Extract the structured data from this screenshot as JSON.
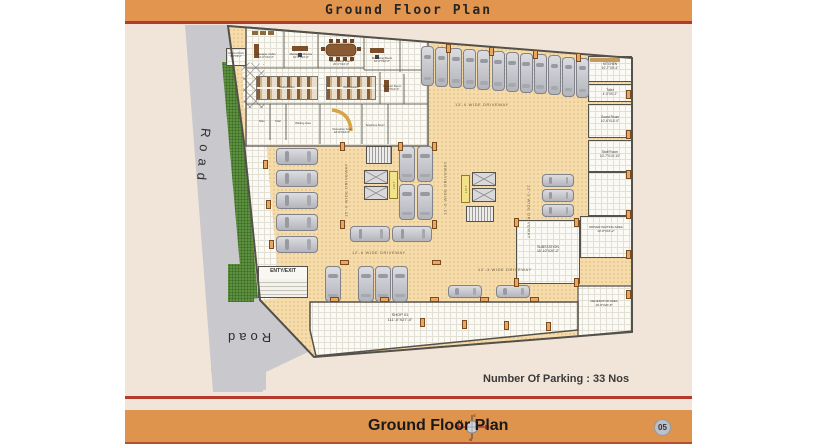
{
  "header": {
    "title": "Ground Floor Plan"
  },
  "footer": {
    "title": "Ground Floor Plan",
    "page": "05",
    "compass": {
      "n": "N",
      "e": "E",
      "s": "S",
      "w": "W"
    }
  },
  "notes": {
    "parking": "Number Of Parking : 33 Nos"
  },
  "roads": {
    "left": "Road",
    "bottom": "Road"
  },
  "driveways": {
    "top": "13'-0 WIDE DRIVEWAY",
    "left": "15'-0 WIDE DRIVEWAY",
    "mid": "12'-0 WIDE DRIVEWAY",
    "right": "12'-3 WIDE DRIVEWAY",
    "bottom": "12'-6 WIDE DRIVEWAY",
    "bottom2": "12'-3 WIDE DRIVEWAY"
  },
  "core": {
    "lift1": "LIFT",
    "lift2": "LIFT",
    "entry_exit": "ENTY/EXIT"
  },
  "rooms": {
    "camera": {
      "name": "Camera Room",
      "dims": "8'-0\"X9'-0\""
    },
    "cabin": {
      "name": "Manager Cabin",
      "dims": "10'-0\"X10'-0\""
    },
    "md": {
      "name": "Managing Director",
      "dims": "10'-0\"X10'-0\""
    },
    "conference": {
      "name": "Conference Room",
      "dims": "20'-0\"X10'-0\""
    },
    "marketing": {
      "name": "Marketing Room",
      "dims": "10'-0\"X10'-0\""
    },
    "account": {
      "name": "Account Room",
      "dims": "8'-0\"X10'-0\""
    },
    "workstation1": {
      "name": "Workstation",
      "dims": "14'-0\"X8'-6\""
    },
    "workstation2": {
      "name": "Workstation",
      "dims": "14'-0\"X8'-6\""
    },
    "toilet1": {
      "name": "Toilet",
      "dims": ""
    },
    "toilet2": {
      "name": "Toilet",
      "dims": ""
    },
    "waiting": {
      "name": "Waiting Area",
      "dims": ""
    },
    "reception": {
      "name": "Reception Area",
      "dims": "16'-0\"X10'-6\""
    },
    "telephone": {
      "name": "Telephone Room",
      "dims": ""
    },
    "kitchen": {
      "name": "KITCHEN",
      "dims": "10'-7\"X5'-4\""
    },
    "toilet_r": {
      "name": "Toilet",
      "dims": "4'-0\"X5'-2\""
    },
    "guard": {
      "name": "Guard Room",
      "dims": "10'-6\"X10'-0\""
    },
    "staff": {
      "name": "Staff Room",
      "dims": "10'-7\"X10'-10\""
    },
    "driver": {
      "name": "DRIVER WAITING AREA",
      "dims": "10'-8\"X16'-2\""
    },
    "substation": {
      "name": "SUBSTATION",
      "dims": "15'-10\"X20'-2\""
    },
    "generator": {
      "name": "GENERATOR AREA",
      "dims": "10'-8\"X20'-8\""
    },
    "shop": {
      "name": "SHOP 01",
      "dims": "111'-0\"X27'-0\""
    }
  }
}
